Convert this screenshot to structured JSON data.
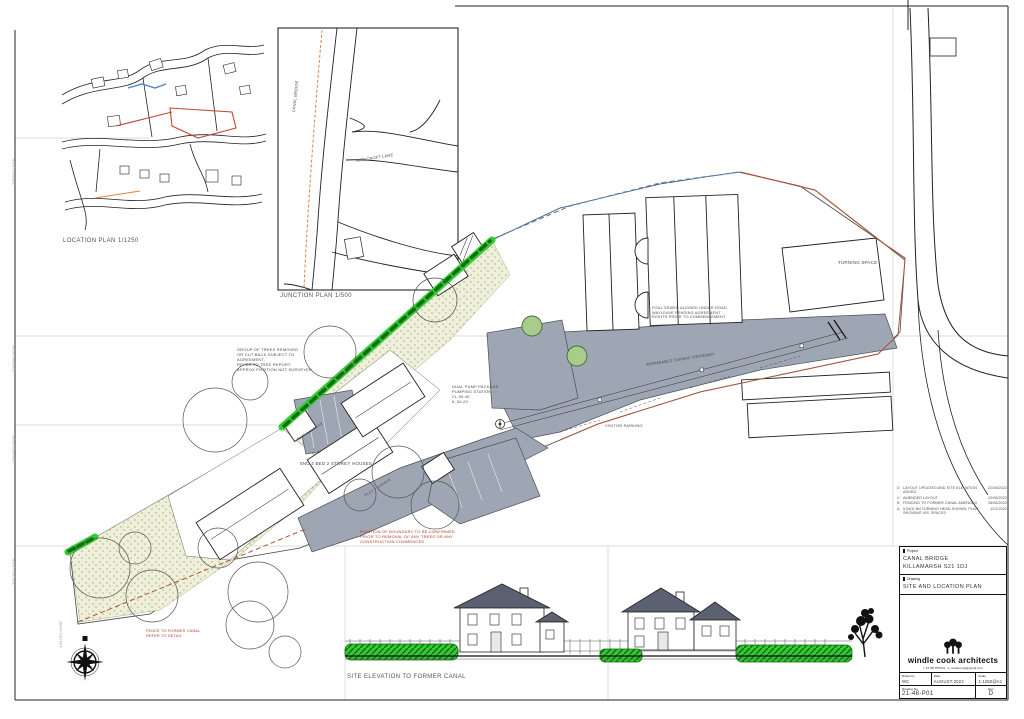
{
  "plans": {
    "location_plan_label": "LOCATION PLAN 1/1250",
    "junction_plan_label": "JUNCTION PLAN 1/500",
    "elevation_label": "SITE ELEVATION TO FORMER CANAL"
  },
  "streets": {
    "canal_bridge": "CANAL BRIDGE",
    "kirkcroft_lane": "KIRKCROFT LANE"
  },
  "notes": {
    "trees": [
      "GROUP OF TREES REMOVED",
      "OR CUT BACK SUBJECT TO",
      "AGREEMENT.",
      "REFER TO TREE REPORT.",
      "APPROX POSITION NOT SURVEYED"
    ],
    "pump": [
      "DUAL PUMP PACKAGE",
      "PUMPING STATION",
      "CL 55.40",
      "IL 54.20"
    ],
    "houses": "5NO 4 BED 2 STOREY HOUSES",
    "visitor": "VISITOR PARKING",
    "tarmac": "PERMEABLE TARMAC DRIVEWAY",
    "turning": "TURNING SPACE",
    "boundary": [
      "POSITION OF BOUNDARY TO BE CONFIRMED",
      "PRIOR TO REMOVAL OF ANY TREES OR ANY",
      "CONSTRUCTION COMMENCES"
    ],
    "sewer": [
      "FOUL SEWER ALIGNED UNDER ROAD,",
      "WAYLEAVE PENDING AGREEMENT",
      "RIGHTS PRIOR TO COMMENCEMENT"
    ],
    "canal_fence": [
      "FENCE TO FORMER CANAL",
      "REFER TO DETAIL"
    ],
    "plot_a": "PLOT 4 GARAGE",
    "plot_b": "PLOT 2 GARAGE"
  },
  "grid_labels": [
    "380600.000N",
    "380500.000N",
    "380400.000N",
    "380300.000N",
    "445750.000E"
  ],
  "revisions": [
    {
      "rev": "D",
      "note": "LAYOUT UPDATED AND SITE ELEVATION ADDED",
      "date": "22/08/2022"
    },
    {
      "rev": "C",
      "note": "AMENDED LAYOUT",
      "date": "22/08/2022"
    },
    {
      "rev": "B",
      "note": "FENCING TO FORMER CANAL AMENDED",
      "date": "28/06/2022"
    },
    {
      "rev": "A",
      "note": "5 (NO) 5M TURNING HEAD SHOWN, PLAN SHOWING VIS. SPACES",
      "date": "12/1/2022"
    }
  ],
  "title_block": {
    "project_label": "Project",
    "project_name": "CANAL BRIDGE",
    "project_address": "KILLAMARSH S21 1DJ",
    "drawing_label": "Drawing",
    "drawing_title": "SITE AND LOCATION PLAN",
    "firm_name": "windle cook architects",
    "firm_contact": "t: 07790 857001 · e: windlecook@gmail.com",
    "drawn_by_label": "Drawn by",
    "drawn_by": "WC",
    "date_label": "Date",
    "date": "AUGUST 2022",
    "scale_label": "Scale",
    "scale": "1:1250@A1",
    "drawing_no_label": "Drawing No.",
    "drawing_no": "21-48-P01",
    "rev_label": "Rev.",
    "rev": "D"
  },
  "colors": {
    "fence_green": "#35c935",
    "road_grey": "#9ea6b3",
    "landscaping": "#eff0da",
    "boundary_red": "#a8543a",
    "boundary_blue": "#4f83c4"
  }
}
